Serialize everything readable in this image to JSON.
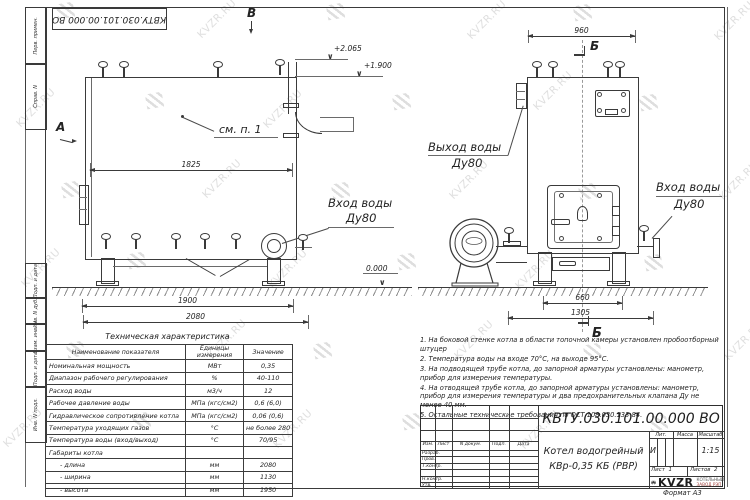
{
  "page": {
    "watermark_text": "KVZR.RU",
    "format_label": "Формат  А3"
  },
  "top_stamp": {
    "doc_number": "КВТУ.030.101.00.000  ВО"
  },
  "margin_labels": {
    "top": [
      "Перв. примен.",
      "Справ. N"
    ],
    "bottom": [
      "Подп. и дата",
      "Инв. N дубл.",
      "Взам. инв. N",
      "Подп. и дата",
      "Инв. N подл."
    ]
  },
  "side_view": {
    "view_letter_b": "В",
    "view_letter_a": "А",
    "callout": "см. п. 1",
    "inlet_line1": "Вход воды",
    "inlet_line2": "Ду80",
    "elev_top": "+2.065",
    "elev_mid": "+1.900",
    "elev_zero": "0.000",
    "dim_top": "1825",
    "dim_bottom1": "1900",
    "dim_bottom2": "2080"
  },
  "front_view": {
    "section_letter": "Б",
    "outlet_line1": "Выход воды",
    "outlet_line2": "Ду80",
    "inlet_line1": "Вход воды",
    "inlet_line2": "Ду80",
    "dim_top": "960",
    "dim_bottom1": "660",
    "dim_bottom2": "1305"
  },
  "tech_table": {
    "title": "Техническая характеристика",
    "headers": [
      "Наименование показателя",
      "Единицы измерения",
      "Значение"
    ],
    "rows": [
      [
        "Номинальная мощность",
        "МВт",
        "0,35"
      ],
      [
        "Диапазон рабочего регулирования",
        "%",
        "40-110"
      ],
      [
        "Расход воды",
        "м3/ч",
        "12"
      ],
      [
        "Рабочее давление воды",
        "МПа (кгс/см2)",
        "0,6 (6,0)"
      ],
      [
        "Гидравлическое сопротивление котла",
        "МПа (кгс/см2)",
        "0,06 (0,6)"
      ],
      [
        "Температура уходящих газов",
        "°С",
        "не более 280"
      ],
      [
        "Температура воды (вход/выход)",
        "°С",
        "70/95"
      ],
      [
        "Габариты котла",
        "",
        ""
      ],
      [
        "- длина",
        "мм",
        "2080"
      ],
      [
        "- ширина",
        "мм",
        "1130"
      ],
      [
        "- высота",
        "мм",
        "1950"
      ]
    ]
  },
  "notes": [
    "1.  На боковой стенке котла в области топочной камеры установлен пробоотборный штуцер",
    "2.  Температура воды на входе 70°С, на выходе 95°С.",
    "3.  На подводящей трубе котла, до запорной арматуры установлены: манометр, прибор для измерения температуры.",
    "4.  На отводящей трубе котла, до запорной арматуры установлены: манометр, прибор для измерения температуры и два предохранительных клапана Ду не менее 40 мм.",
    "5.  Остальные технические требования по ОСТ 108.030.133-84."
  ],
  "title_block": {
    "doc_number": "КВТУ.030.101.00.000  ВО",
    "product_line1": "Котел водогрейный",
    "product_line2": "КВр-0,35  КБ  (РВР)",
    "change_cols": [
      "Изм.",
      "Лист",
      "N докум.",
      "Подп.",
      "Дата"
    ],
    "sign_rows": [
      "Разраб.",
      "Пров.",
      "Т.контр.",
      "",
      "Н.контр.",
      "Утв."
    ],
    "lit_label": "Лит.",
    "mass_label": "Масса",
    "scale_label": "Масштаб",
    "lit_value": "И",
    "scale_value": "1:15",
    "sheet_label": "Лист",
    "sheet_value": "1",
    "sheets_label": "Листов",
    "sheets_value": "2",
    "brand": "KVZR",
    "brand_line1": "КОТЕЛЬНЫЙ",
    "brand_line2": "ЗАВОД РЭП"
  }
}
